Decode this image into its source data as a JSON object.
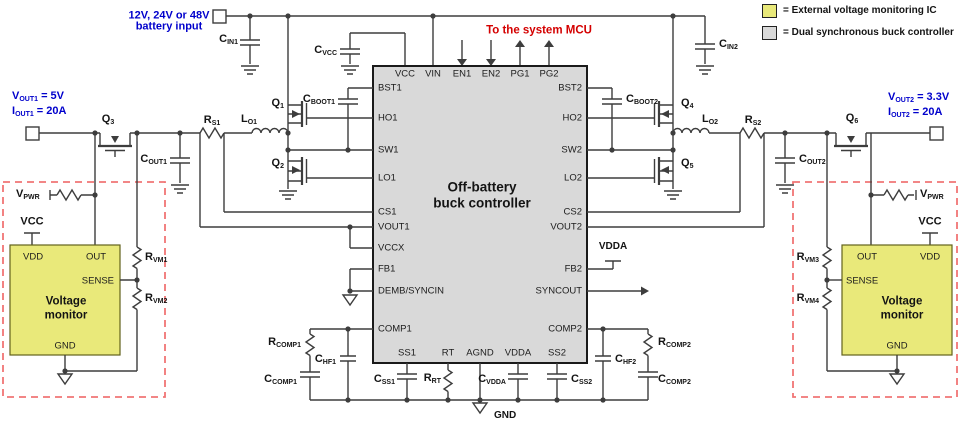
{
  "colors": {
    "blue": "#0000cc",
    "red": "#d40000",
    "wire": "#3d3d3d",
    "ic_fill": "#d9d9d9",
    "ic_border": "#1a1a1a",
    "monitor_fill": "#e9e97a",
    "monitor_border": "#62621c",
    "dashed_box": "#f07575"
  },
  "legend": {
    "items": [
      {
        "label": "= External voltage monitoring IC",
        "swatch_color": "#e9e97a"
      },
      {
        "label": "= Dual synchronous buck controller",
        "swatch_color": "#d9d9d9"
      }
    ]
  },
  "labels": [
    {
      "n": "battery-input-note-line1",
      "s": "blue",
      "x": 169,
      "y": 16,
      "a": "c",
      "p": [
        {
          "t": "12V, 24V or 48V"
        }
      ]
    },
    {
      "n": "battery-input-note-line2",
      "s": "blue",
      "x": 169,
      "y": 27,
      "a": "c",
      "p": [
        {
          "t": "battery input"
        }
      ]
    },
    {
      "n": "vout1-note",
      "s": "blue",
      "x": 12,
      "y": 97,
      "a": "l",
      "p": [
        {
          "t": "V"
        },
        {
          "t": "OUT1",
          "sub": 1
        },
        {
          "t": " = 5V"
        }
      ]
    },
    {
      "n": "iout1-note",
      "s": "blue",
      "x": 12,
      "y": 112,
      "a": "l",
      "p": [
        {
          "t": "I"
        },
        {
          "t": "OUT1",
          "sub": 1
        },
        {
          "t": " = 20A"
        }
      ]
    },
    {
      "n": "vout2-note",
      "s": "blue",
      "x": 888,
      "y": 98,
      "a": "l",
      "p": [
        {
          "t": "V"
        },
        {
          "t": "OUT2",
          "sub": 1
        },
        {
          "t": " = 3.3V"
        }
      ]
    },
    {
      "n": "iout2-note",
      "s": "blue",
      "x": 888,
      "y": 113,
      "a": "l",
      "p": [
        {
          "t": "I"
        },
        {
          "t": "OUT2",
          "sub": 1
        },
        {
          "t": " = 20A"
        }
      ]
    },
    {
      "n": "to-system-mcu-note",
      "s": "red",
      "x": 539,
      "y": 31,
      "a": "c",
      "p": [
        {
          "t": "To the system MCU"
        }
      ]
    },
    {
      "n": "ic-title-line1",
      "s": "title",
      "x": 482,
      "y": 187,
      "a": "c",
      "p": [
        {
          "t": "Off-battery"
        }
      ]
    },
    {
      "n": "ic-title-line2",
      "s": "title",
      "x": 482,
      "y": 203,
      "a": "c",
      "p": [
        {
          "t": "buck controller"
        }
      ]
    },
    {
      "n": "pin-vcc",
      "s": "pin",
      "x": 405,
      "y": 74,
      "a": "c",
      "p": [
        {
          "t": "VCC"
        }
      ]
    },
    {
      "n": "pin-vin",
      "s": "pin",
      "x": 433,
      "y": 74,
      "a": "c",
      "p": [
        {
          "t": "VIN"
        }
      ]
    },
    {
      "n": "pin-en1",
      "s": "pin",
      "x": 462,
      "y": 74,
      "a": "c",
      "p": [
        {
          "t": "EN1"
        }
      ]
    },
    {
      "n": "pin-en2",
      "s": "pin",
      "x": 491,
      "y": 74,
      "a": "c",
      "p": [
        {
          "t": "EN2"
        }
      ]
    },
    {
      "n": "pin-pg1",
      "s": "pin",
      "x": 520,
      "y": 74,
      "a": "c",
      "p": [
        {
          "t": "PG1"
        }
      ]
    },
    {
      "n": "pin-pg2",
      "s": "pin",
      "x": 549,
      "y": 74,
      "a": "c",
      "p": [
        {
          "t": "PG2"
        }
      ]
    },
    {
      "n": "pin-bst1",
      "s": "pin",
      "x": 378,
      "y": 88,
      "a": "l",
      "p": [
        {
          "t": "BST1"
        }
      ]
    },
    {
      "n": "pin-ho1",
      "s": "pin",
      "x": 378,
      "y": 118,
      "a": "l",
      "p": [
        {
          "t": "HO1"
        }
      ]
    },
    {
      "n": "pin-sw1",
      "s": "pin",
      "x": 378,
      "y": 150,
      "a": "l",
      "p": [
        {
          "t": "SW1"
        }
      ]
    },
    {
      "n": "pin-lo1",
      "s": "pin",
      "x": 378,
      "y": 178,
      "a": "l",
      "p": [
        {
          "t": "LO1"
        }
      ]
    },
    {
      "n": "pin-cs1",
      "s": "pin",
      "x": 378,
      "y": 212,
      "a": "l",
      "p": [
        {
          "t": "CS1"
        }
      ]
    },
    {
      "n": "pin-vout1",
      "s": "pin",
      "x": 378,
      "y": 227,
      "a": "l",
      "p": [
        {
          "t": "VOUT1"
        }
      ]
    },
    {
      "n": "pin-vccx",
      "s": "pin",
      "x": 378,
      "y": 248,
      "a": "l",
      "p": [
        {
          "t": "VCCX"
        }
      ]
    },
    {
      "n": "pin-fb1",
      "s": "pin",
      "x": 378,
      "y": 269,
      "a": "l",
      "p": [
        {
          "t": "FB1"
        }
      ]
    },
    {
      "n": "pin-demb-syncin",
      "s": "pin",
      "x": 378,
      "y": 291,
      "a": "l",
      "p": [
        {
          "t": "DEMB/SYNCIN"
        }
      ]
    },
    {
      "n": "pin-comp1",
      "s": "pin",
      "x": 378,
      "y": 329,
      "a": "l",
      "p": [
        {
          "t": "COMP1"
        }
      ]
    },
    {
      "n": "pin-bst2",
      "s": "pin",
      "x": 582,
      "y": 88,
      "a": "r",
      "p": [
        {
          "t": "BST2"
        }
      ]
    },
    {
      "n": "pin-ho2",
      "s": "pin",
      "x": 582,
      "y": 118,
      "a": "r",
      "p": [
        {
          "t": "HO2"
        }
      ]
    },
    {
      "n": "pin-sw2",
      "s": "pin",
      "x": 582,
      "y": 150,
      "a": "r",
      "p": [
        {
          "t": "SW2"
        }
      ]
    },
    {
      "n": "pin-lo2",
      "s": "pin",
      "x": 582,
      "y": 178,
      "a": "r",
      "p": [
        {
          "t": "LO2"
        }
      ]
    },
    {
      "n": "pin-cs2",
      "s": "pin",
      "x": 582,
      "y": 212,
      "a": "r",
      "p": [
        {
          "t": "CS2"
        }
      ]
    },
    {
      "n": "pin-vout2",
      "s": "pin",
      "x": 582,
      "y": 227,
      "a": "r",
      "p": [
        {
          "t": "VOUT2"
        }
      ]
    },
    {
      "n": "pin-fb2",
      "s": "pin",
      "x": 582,
      "y": 269,
      "a": "r",
      "p": [
        {
          "t": "FB2"
        }
      ]
    },
    {
      "n": "pin-syncout",
      "s": "pin",
      "x": 582,
      "y": 291,
      "a": "r",
      "p": [
        {
          "t": "SYNCOUT"
        }
      ]
    },
    {
      "n": "pin-comp2",
      "s": "pin",
      "x": 582,
      "y": 329,
      "a": "r",
      "p": [
        {
          "t": "COMP2"
        }
      ]
    },
    {
      "n": "pin-ss1",
      "s": "pin",
      "x": 407,
      "y": 353,
      "a": "c",
      "p": [
        {
          "t": "SS1"
        }
      ]
    },
    {
      "n": "pin-rt",
      "s": "pin",
      "x": 448,
      "y": 353,
      "a": "c",
      "p": [
        {
          "t": "RT"
        }
      ]
    },
    {
      "n": "pin-agnd",
      "s": "pin",
      "x": 480,
      "y": 353,
      "a": "c",
      "p": [
        {
          "t": "AGND"
        }
      ]
    },
    {
      "n": "pin-vdda",
      "s": "pin",
      "x": 518,
      "y": 353,
      "a": "c",
      "p": [
        {
          "t": "VDDA"
        }
      ]
    },
    {
      "n": "pin-ss2",
      "s": "pin",
      "x": 557,
      "y": 353,
      "a": "c",
      "p": [
        {
          "t": "SS2"
        }
      ]
    },
    {
      "n": "comp-cin1",
      "s": "comp",
      "x": 238,
      "y": 40,
      "a": "r",
      "p": [
        {
          "t": "C"
        },
        {
          "t": "IN1",
          "sub": 1
        }
      ]
    },
    {
      "n": "comp-cvcc",
      "s": "comp",
      "x": 337,
      "y": 51,
      "a": "r",
      "p": [
        {
          "t": "C"
        },
        {
          "t": "VCC",
          "sub": 1
        }
      ]
    },
    {
      "n": "comp-cboot1",
      "s": "comp",
      "x": 335,
      "y": 100,
      "a": "r",
      "p": [
        {
          "t": "C"
        },
        {
          "t": "BOOT1",
          "sub": 1
        }
      ]
    },
    {
      "n": "comp-cboot2",
      "s": "comp",
      "x": 626,
      "y": 100,
      "a": "l",
      "p": [
        {
          "t": "C"
        },
        {
          "t": "BOOT2",
          "sub": 1
        }
      ]
    },
    {
      "n": "comp-cin2",
      "s": "comp",
      "x": 719,
      "y": 45,
      "a": "l",
      "p": [
        {
          "t": "C"
        },
        {
          "t": "IN2",
          "sub": 1
        }
      ]
    },
    {
      "n": "comp-q1",
      "s": "comp",
      "x": 284,
      "y": 104,
      "a": "r",
      "p": [
        {
          "t": "Q"
        },
        {
          "t": "1",
          "sub": 1
        }
      ]
    },
    {
      "n": "comp-q2",
      "s": "comp",
      "x": 284,
      "y": 164,
      "a": "r",
      "p": [
        {
          "t": "Q"
        },
        {
          "t": "2",
          "sub": 1
        }
      ]
    },
    {
      "n": "comp-q3",
      "s": "comp",
      "x": 108,
      "y": 120,
      "a": "c",
      "p": [
        {
          "t": "Q"
        },
        {
          "t": "3",
          "sub": 1
        }
      ]
    },
    {
      "n": "comp-q4",
      "s": "comp",
      "x": 681,
      "y": 104,
      "a": "l",
      "p": [
        {
          "t": "Q"
        },
        {
          "t": "4",
          "sub": 1
        }
      ]
    },
    {
      "n": "comp-q5",
      "s": "comp",
      "x": 681,
      "y": 164,
      "a": "l",
      "p": [
        {
          "t": "Q"
        },
        {
          "t": "5",
          "sub": 1
        }
      ]
    },
    {
      "n": "comp-q6",
      "s": "comp",
      "x": 852,
      "y": 119,
      "a": "c",
      "p": [
        {
          "t": "Q"
        },
        {
          "t": "6",
          "sub": 1
        }
      ]
    },
    {
      "n": "comp-rs1",
      "s": "comp",
      "x": 212,
      "y": 121,
      "a": "c",
      "p": [
        {
          "t": "R"
        },
        {
          "t": "S1",
          "sub": 1
        }
      ]
    },
    {
      "n": "comp-lo1",
      "s": "comp",
      "x": 249,
      "y": 120,
      "a": "c",
      "p": [
        {
          "t": "L"
        },
        {
          "t": "O1",
          "sub": 1
        }
      ]
    },
    {
      "n": "comp-lo2",
      "s": "comp",
      "x": 710,
      "y": 120,
      "a": "c",
      "p": [
        {
          "t": "L"
        },
        {
          "t": "O2",
          "sub": 1
        }
      ]
    },
    {
      "n": "comp-rs2",
      "s": "comp",
      "x": 753,
      "y": 121,
      "a": "c",
      "p": [
        {
          "t": "R"
        },
        {
          "t": "S2",
          "sub": 1
        }
      ]
    },
    {
      "n": "comp-cout1",
      "s": "comp",
      "x": 167,
      "y": 160,
      "a": "r",
      "p": [
        {
          "t": "C"
        },
        {
          "t": "OUT1",
          "sub": 1
        }
      ]
    },
    {
      "n": "comp-cout2",
      "s": "comp",
      "x": 799,
      "y": 160,
      "a": "l",
      "p": [
        {
          "t": "C"
        },
        {
          "t": "OUT2",
          "sub": 1
        }
      ]
    },
    {
      "n": "comp-rcomp1",
      "s": "comp",
      "x": 301,
      "y": 343,
      "a": "r",
      "p": [
        {
          "t": "R"
        },
        {
          "t": "COMP1",
          "sub": 1
        }
      ]
    },
    {
      "n": "comp-ccomp1",
      "s": "comp",
      "x": 297,
      "y": 380,
      "a": "r",
      "p": [
        {
          "t": "C"
        },
        {
          "t": "COMP1",
          "sub": 1
        }
      ]
    },
    {
      "n": "comp-chf1",
      "s": "comp",
      "x": 336,
      "y": 360,
      "a": "r",
      "p": [
        {
          "t": "C"
        },
        {
          "t": "HF1",
          "sub": 1
        }
      ]
    },
    {
      "n": "comp-css1",
      "s": "comp",
      "x": 395,
      "y": 380,
      "a": "r",
      "p": [
        {
          "t": "C"
        },
        {
          "t": "SS1",
          "sub": 1
        }
      ]
    },
    {
      "n": "comp-rrt",
      "s": "comp",
      "x": 441,
      "y": 379,
      "a": "r",
      "p": [
        {
          "t": "R"
        },
        {
          "t": "RT",
          "sub": 1
        }
      ]
    },
    {
      "n": "comp-cvdda",
      "s": "comp",
      "x": 506,
      "y": 380,
      "a": "r",
      "p": [
        {
          "t": "C"
        },
        {
          "t": "VDDA",
          "sub": 1
        }
      ]
    },
    {
      "n": "comp-css2",
      "s": "comp",
      "x": 571,
      "y": 380,
      "a": "l",
      "p": [
        {
          "t": "C"
        },
        {
          "t": "SS2",
          "sub": 1
        }
      ]
    },
    {
      "n": "comp-chf2",
      "s": "comp",
      "x": 615,
      "y": 360,
      "a": "l",
      "p": [
        {
          "t": "C"
        },
        {
          "t": "HF2",
          "sub": 1
        }
      ]
    },
    {
      "n": "comp-rcomp2",
      "s": "comp",
      "x": 658,
      "y": 343,
      "a": "l",
      "p": [
        {
          "t": "R"
        },
        {
          "t": "COMP2",
          "sub": 1
        }
      ]
    },
    {
      "n": "comp-ccomp2",
      "s": "comp",
      "x": 658,
      "y": 380,
      "a": "l",
      "p": [
        {
          "t": "C"
        },
        {
          "t": "COMP2",
          "sub": 1
        }
      ]
    },
    {
      "n": "comp-rvm1",
      "s": "comp",
      "x": 145,
      "y": 258,
      "a": "l",
      "p": [
        {
          "t": "R"
        },
        {
          "t": "VM1",
          "sub": 1
        }
      ]
    },
    {
      "n": "comp-rvm2",
      "s": "comp",
      "x": 145,
      "y": 299,
      "a": "l",
      "p": [
        {
          "t": "R"
        },
        {
          "t": "VM2",
          "sub": 1
        }
      ]
    },
    {
      "n": "comp-rvm3",
      "s": "comp",
      "x": 819,
      "y": 258,
      "a": "r",
      "p": [
        {
          "t": "R"
        },
        {
          "t": "VM3",
          "sub": 1
        }
      ]
    },
    {
      "n": "comp-rvm4",
      "s": "comp",
      "x": 819,
      "y": 299,
      "a": "r",
      "p": [
        {
          "t": "R"
        },
        {
          "t": "VM4",
          "sub": 1
        }
      ]
    },
    {
      "n": "vpwr-left-label",
      "s": "comp",
      "x": 16,
      "y": 195,
      "a": "l",
      "p": [
        {
          "t": "V"
        },
        {
          "t": "PWR",
          "sub": 1
        }
      ]
    },
    {
      "n": "vpwr-right-label",
      "s": "comp",
      "x": 920,
      "y": 195,
      "a": "l",
      "p": [
        {
          "t": "V"
        },
        {
          "t": "PWR",
          "sub": 1
        }
      ]
    },
    {
      "n": "vcc-left-supply",
      "s": "supply",
      "x": 32,
      "y": 222,
      "a": "c",
      "p": [
        {
          "t": "VCC"
        }
      ]
    },
    {
      "n": "vcc-right-supply",
      "s": "supply",
      "x": 930,
      "y": 222,
      "a": "c",
      "p": [
        {
          "t": "VCC"
        }
      ]
    },
    {
      "n": "vdda-rail-label",
      "s": "small-bold",
      "x": 613,
      "y": 247,
      "a": "c",
      "p": [
        {
          "t": "VDDA"
        }
      ]
    },
    {
      "n": "gnd-bottom-label",
      "s": "small-bold",
      "x": 494,
      "y": 416,
      "a": "l",
      "p": [
        {
          "t": "GND"
        }
      ]
    },
    {
      "n": "monitor-left-pin-vdd",
      "s": "pin",
      "x": 23,
      "y": 257,
      "a": "l",
      "p": [
        {
          "t": "VDD"
        }
      ]
    },
    {
      "n": "monitor-left-pin-out",
      "s": "pin",
      "x": 86,
      "y": 257,
      "a": "l",
      "p": [
        {
          "t": "OUT"
        }
      ]
    },
    {
      "n": "monitor-left-pin-sense",
      "s": "pin",
      "x": 114,
      "y": 281,
      "a": "r",
      "p": [
        {
          "t": "SENSE"
        }
      ]
    },
    {
      "n": "monitor-left-pin-gnd",
      "s": "pin",
      "x": 65,
      "y": 346,
      "a": "c",
      "p": [
        {
          "t": "GND"
        }
      ]
    },
    {
      "n": "monitor-left-title-line1",
      "s": "mon",
      "x": 66,
      "y": 302,
      "a": "c",
      "p": [
        {
          "t": "Voltage"
        }
      ]
    },
    {
      "n": "monitor-left-title-line2",
      "s": "mon",
      "x": 66,
      "y": 316,
      "a": "c",
      "p": [
        {
          "t": "monitor"
        }
      ]
    },
    {
      "n": "monitor-right-pin-out",
      "s": "pin",
      "x": 857,
      "y": 257,
      "a": "l",
      "p": [
        {
          "t": "OUT"
        }
      ]
    },
    {
      "n": "monitor-right-pin-vdd",
      "s": "pin",
      "x": 920,
      "y": 257,
      "a": "l",
      "p": [
        {
          "t": "VDD"
        }
      ]
    },
    {
      "n": "monitor-right-pin-sense",
      "s": "pin",
      "x": 846,
      "y": 281,
      "a": "l",
      "p": [
        {
          "t": "SENSE"
        }
      ]
    },
    {
      "n": "monitor-right-pin-gnd",
      "s": "pin",
      "x": 897,
      "y": 346,
      "a": "c",
      "p": [
        {
          "t": "GND"
        }
      ]
    },
    {
      "n": "monitor-right-title-line1",
      "s": "mon",
      "x": 902,
      "y": 302,
      "a": "c",
      "p": [
        {
          "t": "Voltage"
        }
      ]
    },
    {
      "n": "monitor-right-title-line2",
      "s": "mon",
      "x": 902,
      "y": 316,
      "a": "c",
      "p": [
        {
          "t": "monitor"
        }
      ]
    }
  ]
}
